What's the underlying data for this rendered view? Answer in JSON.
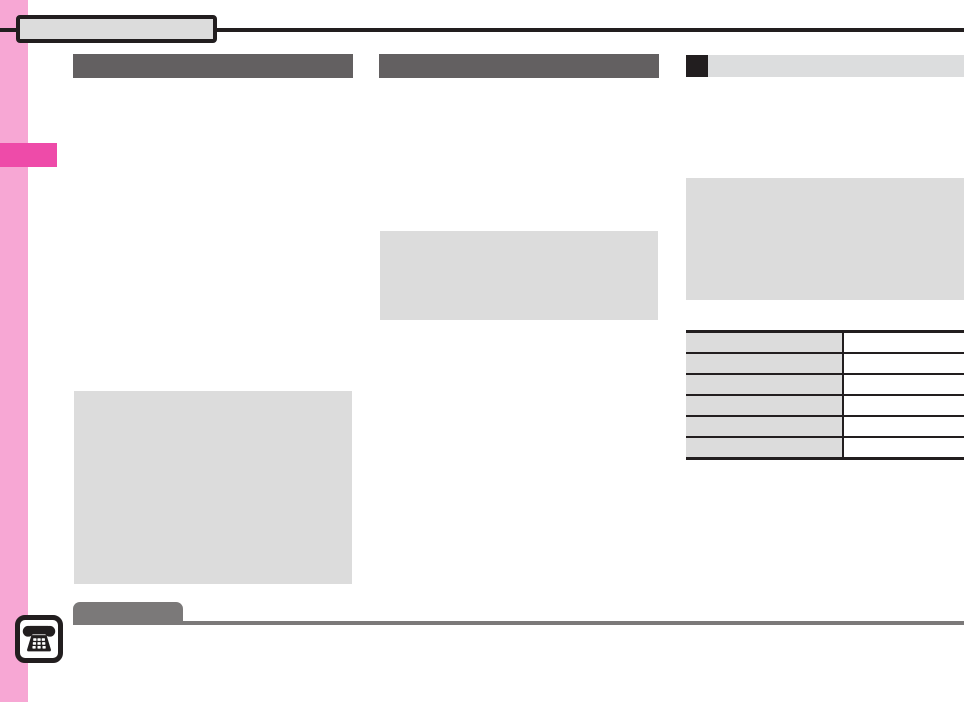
{
  "colors": {
    "sidebar_pink": "#F7A7D4",
    "sidebar_tab_pink": "#EE4BA9",
    "rule_black": "#221E1F",
    "header_bar_gray": "#636061",
    "subheader_bar_gray": "#DCDDDE",
    "content_box_gray": "#DCDCDC",
    "notice_gray": "#7B7979",
    "table_cell_gray": "#DCDCDC"
  },
  "header": {
    "title_box_label": ""
  },
  "columns": {
    "col1_header_label": "",
    "col2_header_label": "",
    "col3_header_label": ""
  },
  "table": {
    "rows": [
      {
        "label": "",
        "value": ""
      },
      {
        "label": "",
        "value": ""
      },
      {
        "label": "",
        "value": ""
      },
      {
        "label": "",
        "value": ""
      },
      {
        "label": "",
        "value": ""
      },
      {
        "label": "",
        "value": ""
      }
    ]
  },
  "notice": {
    "label": ""
  },
  "icons": {
    "phone": "phone-icon"
  }
}
